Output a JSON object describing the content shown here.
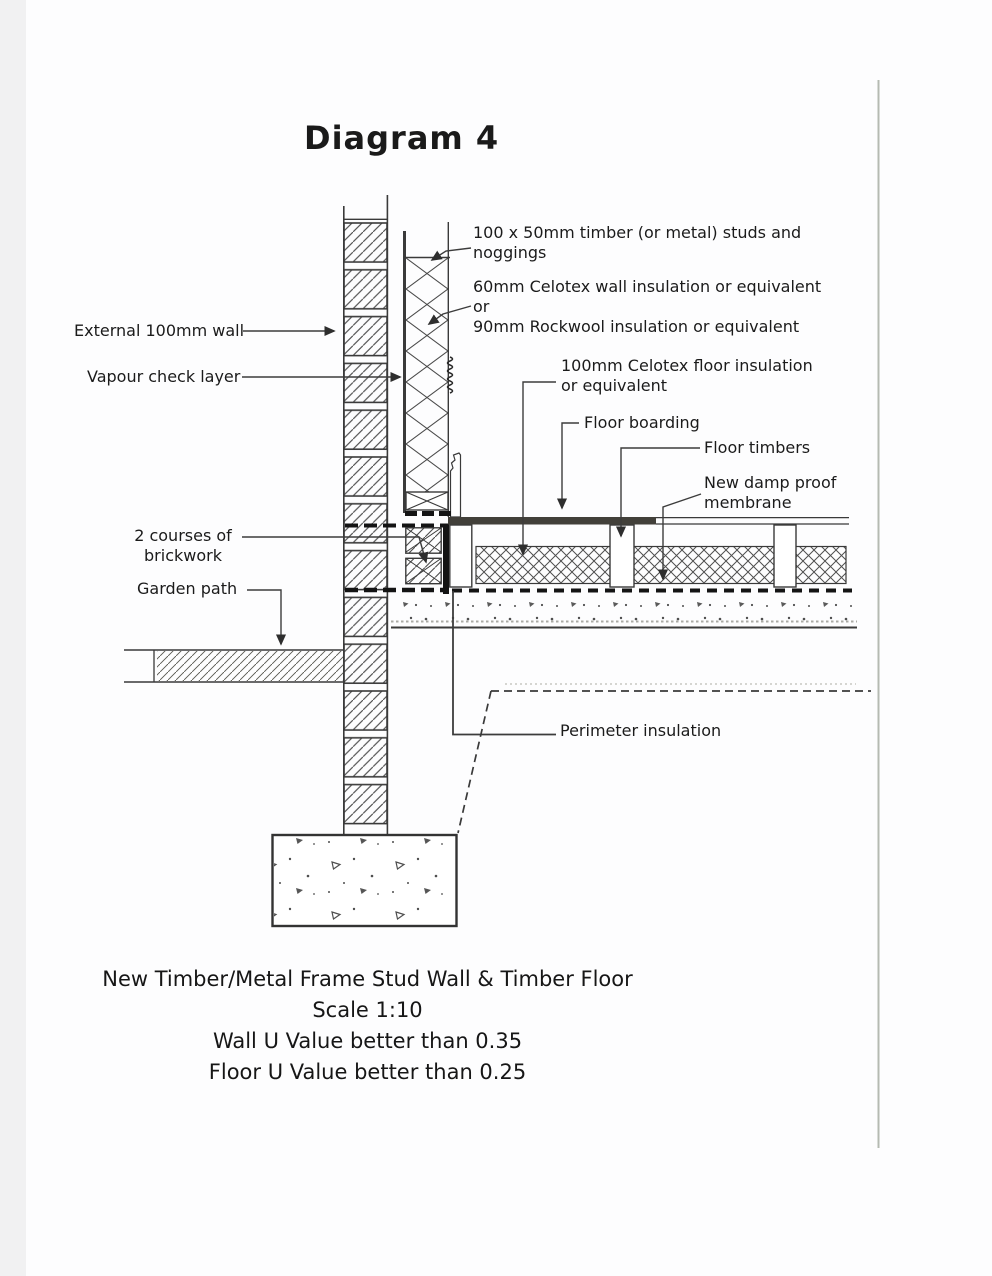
{
  "page": {
    "title": "Diagram 4"
  },
  "labels": {
    "studs": "100 x 50mm timber (or metal) studs and\nnoggings",
    "wall_insulation": "60mm Celotex wall insulation or equivalent\nor\n90mm Rockwool insulation or equivalent",
    "external_wall": "External 100mm wall",
    "vapour_check": "Vapour check layer",
    "floor_insulation": "100mm Celotex floor insulation\nor equivalent",
    "floor_boarding": "Floor boarding",
    "floor_timbers": "Floor timbers",
    "damp_proof_membrane": "New damp proof\nmembrane",
    "brick_courses": "2 courses of\nbrickwork",
    "garden_path": "Garden path",
    "perimeter_insulation": "Perimeter insulation"
  },
  "caption": {
    "line1": "New Timber/Metal Frame Stud Wall & Timber Floor",
    "line2": "Scale 1:10",
    "line3": "Wall U Value better than 0.35",
    "line4": "Floor U Value better than 0.25"
  },
  "colors": {
    "ink": "#3a3a3a",
    "dpm_black": "#141414",
    "boarding": "#42403a",
    "scan_edge": "#f1f1f2",
    "page_fold_line": "#b5bab2"
  }
}
